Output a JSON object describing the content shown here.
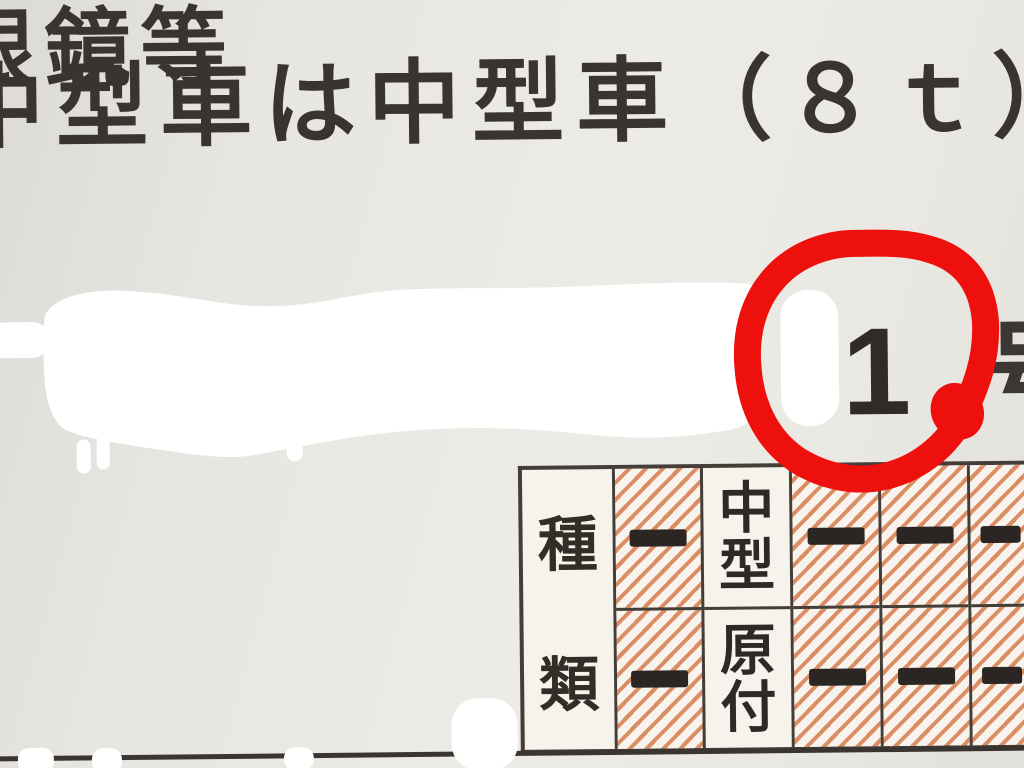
{
  "license": {
    "conditions": [
      "眼鏡等",
      "中型車は中型車（８ｔ）"
    ],
    "number_digit": "1",
    "number_suffix": "号",
    "table": {
      "header_chars": [
        "種",
        "類"
      ],
      "dash_symbol": "—",
      "columns": [
        {
          "hatched": true,
          "top": "—",
          "bottom": "—"
        },
        {
          "hatched": false,
          "top": "中型",
          "bottom": "原付"
        },
        {
          "hatched": true,
          "top": "—",
          "bottom": "—"
        },
        {
          "hatched": true,
          "top": "—",
          "bottom": "—"
        },
        {
          "hatched": true,
          "top": "—",
          "bottom": "—"
        }
      ]
    }
  },
  "annotations": {
    "red_circle": {
      "around": "1",
      "color": "#ee100d"
    },
    "redaction_color": "#ffffff"
  },
  "colors": {
    "card_background": "#e8e6e1",
    "ink": "#39342f",
    "hatch_line": "#db8d63",
    "table_border": "#453d37",
    "dash": "#2b2623"
  }
}
